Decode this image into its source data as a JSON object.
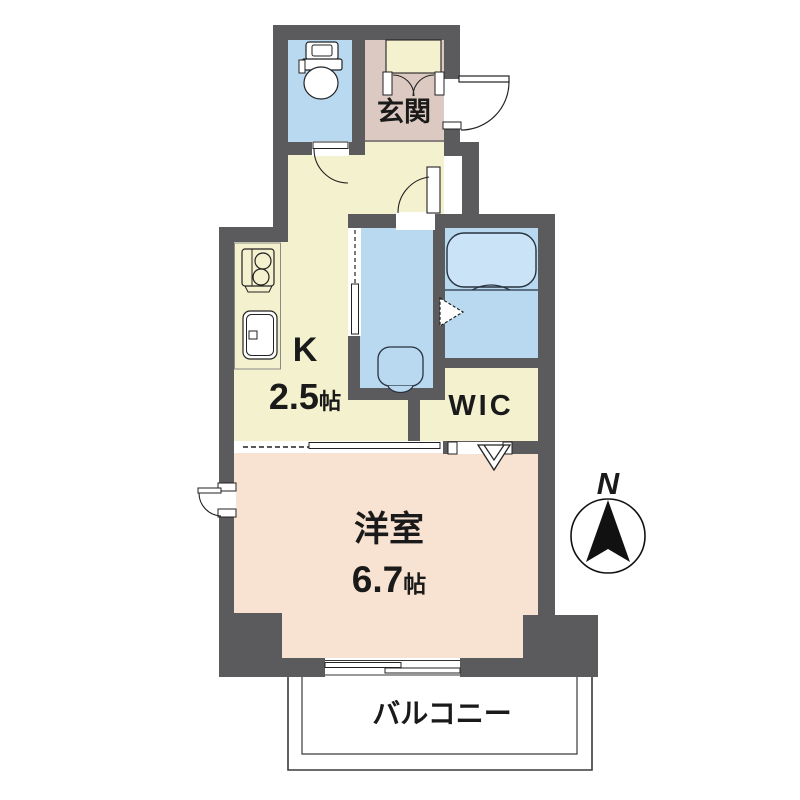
{
  "floorplan": {
    "rooms": {
      "genkan": {
        "label": "玄関"
      },
      "kitchen": {
        "label": "K",
        "area": "2.5",
        "area_unit": "帖"
      },
      "wic": {
        "label": "WIC"
      },
      "western_room": {
        "label": "洋室",
        "area": "6.7",
        "area_unit": "帖"
      },
      "balcony": {
        "label": "バルコニー"
      }
    },
    "compass": {
      "north_label": "N"
    },
    "colors": {
      "wall": "#5b5b5d",
      "kitchen_floor": "#f4f1cf",
      "genkan_floor": "#dccac2",
      "wet_area_floor": "#b9d9f0",
      "bathtub_fill": "#cbe3f7",
      "western_room_floor": "#f8e2d1",
      "balcony_floor": "#ffffff"
    }
  }
}
